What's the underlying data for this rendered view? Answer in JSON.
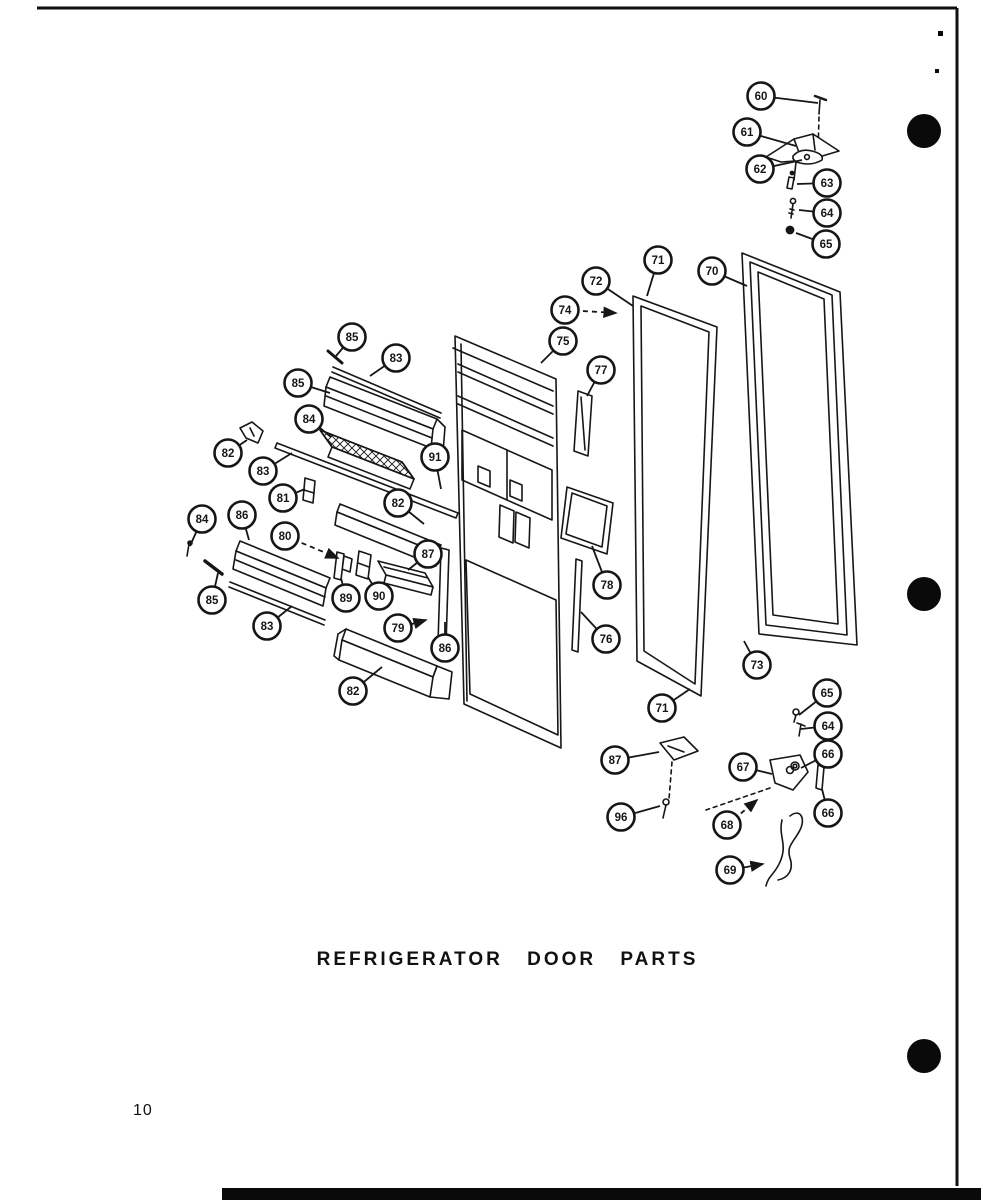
{
  "page": {
    "title": "REFRIGERATOR DOOR PARTS",
    "page_number": "10",
    "ink_color": "#161616",
    "paper_color": "#ffffff"
  },
  "callouts": [
    {
      "label": "60",
      "x": 761,
      "y": 96,
      "tx": 818,
      "ty": 103
    },
    {
      "label": "61",
      "x": 747,
      "y": 132,
      "tx": 796,
      "ty": 146
    },
    {
      "label": "62",
      "x": 760,
      "y": 169,
      "tx": 802,
      "ty": 160
    },
    {
      "label": "63",
      "x": 827,
      "y": 183,
      "tx": 797,
      "ty": 184
    },
    {
      "label": "64",
      "x": 827,
      "y": 213,
      "tx": 799,
      "ty": 210
    },
    {
      "label": "65",
      "x": 826,
      "y": 244,
      "tx": 796,
      "ty": 233
    },
    {
      "label": "72",
      "x": 596,
      "y": 281,
      "tx": 633,
      "ty": 306
    },
    {
      "label": "71",
      "x": 658,
      "y": 260,
      "tx": 647,
      "ty": 296
    },
    {
      "label": "70",
      "x": 712,
      "y": 271,
      "tx": 747,
      "ty": 286
    },
    {
      "label": "74",
      "x": 565,
      "y": 310,
      "tx": 616,
      "ty": 313,
      "dashed": true,
      "arrow": true
    },
    {
      "label": "75",
      "x": 563,
      "y": 341,
      "tx": 541,
      "ty": 363
    },
    {
      "label": "77",
      "x": 601,
      "y": 370,
      "tx": 587,
      "ty": 396
    },
    {
      "label": "85",
      "x": 352,
      "y": 337,
      "tx": 336,
      "ty": 356
    },
    {
      "label": "83",
      "x": 396,
      "y": 358,
      "tx": 370,
      "ty": 376
    },
    {
      "label": "85",
      "x": 298,
      "y": 383,
      "tx": 330,
      "ty": 393
    },
    {
      "label": "84",
      "x": 309,
      "y": 419,
      "tx": 331,
      "ty": 437
    },
    {
      "label": "82",
      "x": 228,
      "y": 453,
      "tx": 247,
      "ty": 440
    },
    {
      "label": "83",
      "x": 263,
      "y": 471,
      "tx": 292,
      "ty": 453
    },
    {
      "label": "81",
      "x": 283,
      "y": 498,
      "tx": 305,
      "ty": 489
    },
    {
      "label": "91",
      "x": 435,
      "y": 457,
      "tx": 441,
      "ty": 489
    },
    {
      "label": "82",
      "x": 398,
      "y": 503,
      "tx": 424,
      "ty": 524
    },
    {
      "label": "84",
      "x": 202,
      "y": 519,
      "tx": 190,
      "ty": 546
    },
    {
      "label": "86",
      "x": 242,
      "y": 515,
      "tx": 249,
      "ty": 540
    },
    {
      "label": "80",
      "x": 285,
      "y": 536,
      "tx": 338,
      "ty": 558,
      "dashed": true,
      "arrow": true
    },
    {
      "label": "85",
      "x": 212,
      "y": 600,
      "tx": 218,
      "ty": 573
    },
    {
      "label": "83",
      "x": 267,
      "y": 626,
      "tx": 292,
      "ty": 606
    },
    {
      "label": "89",
      "x": 346,
      "y": 598,
      "tx": 341,
      "ty": 578
    },
    {
      "label": "90",
      "x": 379,
      "y": 596,
      "tx": 368,
      "ty": 577
    },
    {
      "label": "87",
      "x": 428,
      "y": 554,
      "tx": 408,
      "ty": 570
    },
    {
      "label": "79",
      "x": 398,
      "y": 628,
      "tx": 426,
      "ty": 620,
      "arrow": true
    },
    {
      "label": "86",
      "x": 445,
      "y": 648,
      "tx": 445,
      "ty": 622
    },
    {
      "label": "82",
      "x": 353,
      "y": 691,
      "tx": 382,
      "ty": 667
    },
    {
      "label": "78",
      "x": 607,
      "y": 585,
      "tx": 592,
      "ty": 546
    },
    {
      "label": "76",
      "x": 606,
      "y": 639,
      "tx": 581,
      "ty": 612
    },
    {
      "label": "73",
      "x": 757,
      "y": 665,
      "tx": 744,
      "ty": 641
    },
    {
      "label": "71",
      "x": 662,
      "y": 708,
      "tx": 690,
      "ty": 689
    },
    {
      "label": "65",
      "x": 827,
      "y": 693,
      "tx": 799,
      "ty": 715
    },
    {
      "label": "64",
      "x": 828,
      "y": 726,
      "tx": 801,
      "ty": 729
    },
    {
      "label": "66",
      "x": 828,
      "y": 754,
      "tx": 801,
      "ty": 768
    },
    {
      "label": "66",
      "x": 828,
      "y": 813,
      "tx": 822,
      "ty": 789
    },
    {
      "label": "87",
      "x": 615,
      "y": 760,
      "tx": 659,
      "ty": 752
    },
    {
      "label": "67",
      "x": 743,
      "y": 767,
      "tx": 772,
      "ty": 774
    },
    {
      "label": "96",
      "x": 621,
      "y": 817,
      "tx": 660,
      "ty": 806
    },
    {
      "label": "68",
      "x": 727,
      "y": 825,
      "tx": 757,
      "ty": 800,
      "dashed": true,
      "arrow": true
    },
    {
      "label": "69",
      "x": 730,
      "y": 870,
      "tx": 763,
      "ty": 864,
      "arrow": true
    }
  ],
  "punch_holes": [
    {
      "x": 924,
      "y": 131,
      "r": 17
    },
    {
      "x": 924,
      "y": 594,
      "r": 17
    },
    {
      "x": 924,
      "y": 1056,
      "r": 17
    }
  ],
  "margin_ticks": [
    {
      "x": 938,
      "y": 31,
      "w": 5,
      "h": 5
    },
    {
      "x": 935,
      "y": 69,
      "w": 4,
      "h": 4
    }
  ]
}
